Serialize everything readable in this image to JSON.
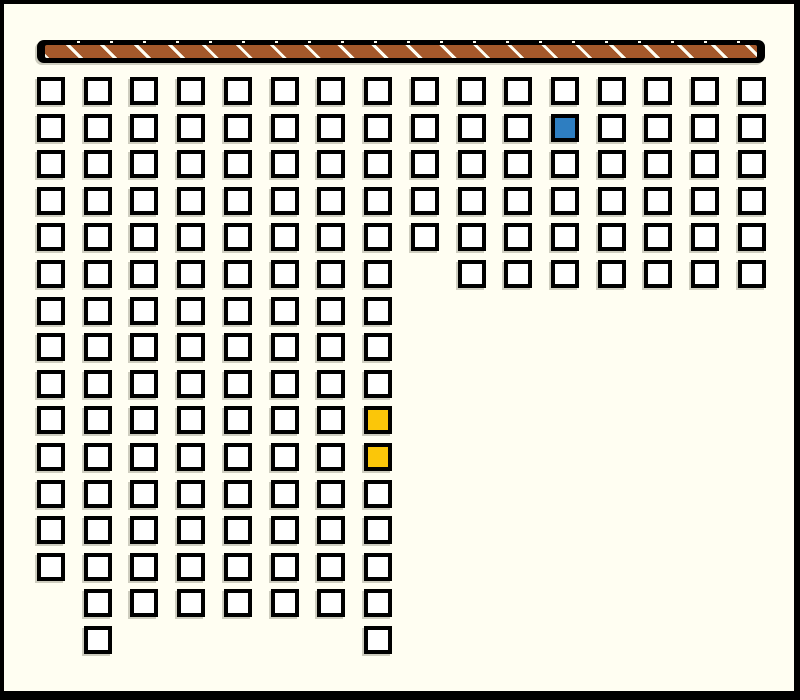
{
  "scene": {
    "background_color": "#FFFEF2",
    "frame_color": "#000000",
    "frame_widths_px": {
      "top": 4,
      "right": 6,
      "bottom": 9,
      "left": 4
    },
    "shadow_color": "rgba(125,125,108,0.38)"
  },
  "wall": {
    "x": 37,
    "y": 40,
    "width": 728,
    "height": 23,
    "outline_color": "#000000",
    "fill_color": "#A5592B",
    "stripe_color": "#FFFEF2",
    "stripe_axis_period_px": 24,
    "stripe_axis_width_px": 3,
    "dot_period_px": 33
  },
  "grid": {
    "origin_x": 37,
    "origin_y": 77,
    "pitch_x": 46.73,
    "pitch_y": 36.6,
    "cell_size": 28,
    "cell_border_px": 4,
    "cell_border_color": "#000000",
    "cell_fill_color": "#FFFFFF",
    "columns": [
      {
        "col": 0,
        "row_start": 0,
        "row_end": 13
      },
      {
        "col": 1,
        "row_start": 0,
        "row_end": 15
      },
      {
        "col": 2,
        "row_start": 0,
        "row_end": 14
      },
      {
        "col": 3,
        "row_start": 0,
        "row_end": 14
      },
      {
        "col": 4,
        "row_start": 0,
        "row_end": 14
      },
      {
        "col": 5,
        "row_start": 0,
        "row_end": 14
      },
      {
        "col": 6,
        "row_start": 0,
        "row_end": 14
      },
      {
        "col": 7,
        "row_start": 0,
        "row_end": 15
      },
      {
        "col": 8,
        "row_start": 0,
        "row_end": 4
      },
      {
        "col": 9,
        "row_start": 0,
        "row_end": 5
      },
      {
        "col": 10,
        "row_start": 0,
        "row_end": 5
      },
      {
        "col": 11,
        "row_start": 0,
        "row_end": 5
      },
      {
        "col": 12,
        "row_start": 0,
        "row_end": 5
      },
      {
        "col": 13,
        "row_start": 0,
        "row_end": 5
      },
      {
        "col": 14,
        "row_start": 0,
        "row_end": 5
      },
      {
        "col": 15,
        "row_start": 0,
        "row_end": 5
      }
    ],
    "highlighted_cells": [
      {
        "col": 11,
        "row": 1,
        "color": "#2E7EC1",
        "name": "blue-highlighted-cell"
      },
      {
        "col": 7,
        "row": 9,
        "color": "#FBC609",
        "name": "yellow-highlighted-cell-1"
      },
      {
        "col": 7,
        "row": 10,
        "color": "#FBC609",
        "name": "yellow-highlighted-cell-2"
      }
    ]
  }
}
